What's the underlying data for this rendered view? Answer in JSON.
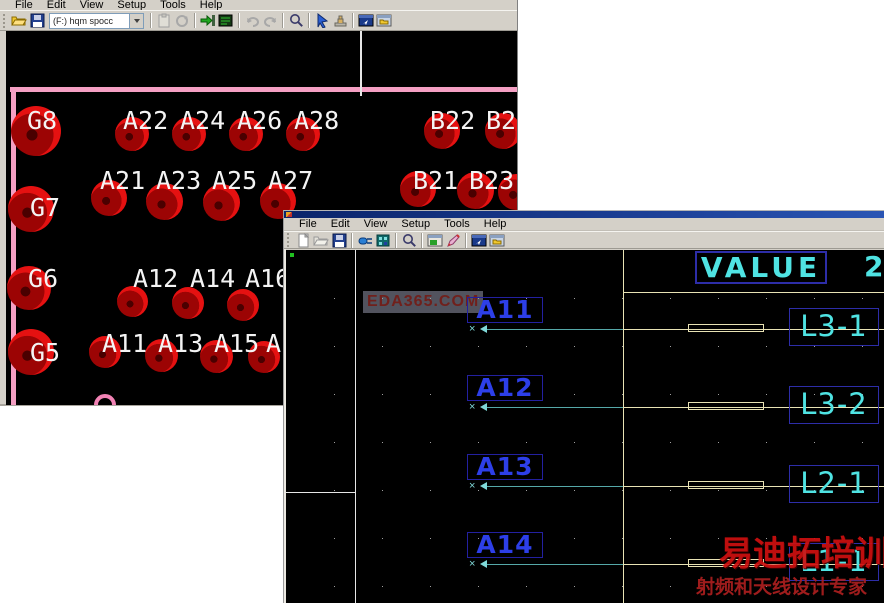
{
  "back_window": {
    "menu": [
      "File",
      "Edit",
      "View",
      "Setup",
      "Tools",
      "Help"
    ],
    "toolbar": {
      "layer_combo_value": "(F:) hqm spocc",
      "icons_file": [
        "open-folder",
        "save"
      ],
      "icons_main": [
        "sep",
        "paste",
        "refresh",
        "sep",
        "import-arrow",
        "board",
        "sep",
        "undo",
        "redo",
        "sep",
        "zoom",
        "sep",
        "select-cursor",
        "stamp",
        "sep",
        "window-arrow",
        "window-folder"
      ]
    },
    "canvas": {
      "board_outline_color": "#f49fc3",
      "pad_labels": [
        {
          "t": "G8",
          "x": 21,
          "y": 77
        },
        {
          "t": "G7",
          "x": 24,
          "y": 164
        },
        {
          "t": "G6",
          "x": 22,
          "y": 235
        },
        {
          "t": "G5",
          "x": 24,
          "y": 309
        },
        {
          "t": "A22",
          "x": 117,
          "y": 77
        },
        {
          "t": "A24",
          "x": 174,
          "y": 77
        },
        {
          "t": "A26",
          "x": 231,
          "y": 77
        },
        {
          "t": "A28",
          "x": 288,
          "y": 77
        },
        {
          "t": "B22",
          "x": 424,
          "y": 77
        },
        {
          "t": "B24",
          "x": 480,
          "y": 77
        },
        {
          "t": "A21",
          "x": 94,
          "y": 137
        },
        {
          "t": "A23",
          "x": 150,
          "y": 137
        },
        {
          "t": "A25",
          "x": 206,
          "y": 137
        },
        {
          "t": "A27",
          "x": 262,
          "y": 137
        },
        {
          "t": "B21",
          "x": 407,
          "y": 137
        },
        {
          "t": "B23",
          "x": 463,
          "y": 137
        },
        {
          "t": "A12",
          "x": 127,
          "y": 235
        },
        {
          "t": "A14",
          "x": 184,
          "y": 235
        },
        {
          "t": "A16",
          "x": 239,
          "y": 235
        },
        {
          "t": "A11",
          "x": 96,
          "y": 300
        },
        {
          "t": "A13",
          "x": 152,
          "y": 300
        },
        {
          "t": "A15",
          "x": 208,
          "y": 300
        },
        {
          "t": "A17",
          "x": 260,
          "y": 300
        }
      ],
      "pads": [
        {
          "x": 30,
          "y": 100,
          "d": 50
        },
        {
          "x": 25,
          "y": 178,
          "d": 46
        },
        {
          "x": 23,
          "y": 257,
          "d": 44
        },
        {
          "x": 25,
          "y": 321,
          "d": 46
        },
        {
          "x": 126,
          "y": 103,
          "d": 34
        },
        {
          "x": 183,
          "y": 103,
          "d": 34
        },
        {
          "x": 240,
          "y": 103,
          "d": 34
        },
        {
          "x": 297,
          "y": 103,
          "d": 34
        },
        {
          "x": 436,
          "y": 100,
          "d": 36
        },
        {
          "x": 497,
          "y": 100,
          "d": 36
        },
        {
          "x": 103,
          "y": 167,
          "d": 36
        },
        {
          "x": 158,
          "y": 170,
          "d": 37
        },
        {
          "x": 215,
          "y": 171,
          "d": 37
        },
        {
          "x": 272,
          "y": 170,
          "d": 36
        },
        {
          "x": 412,
          "y": 158,
          "d": 36
        },
        {
          "x": 469,
          "y": 159,
          "d": 37
        },
        {
          "x": 510,
          "y": 161,
          "d": 36
        },
        {
          "x": 126,
          "y": 270,
          "d": 31
        },
        {
          "x": 182,
          "y": 272,
          "d": 32
        },
        {
          "x": 237,
          "y": 274,
          "d": 32
        },
        {
          "x": 99,
          "y": 321,
          "d": 32
        },
        {
          "x": 155,
          "y": 324,
          "d": 33
        },
        {
          "x": 210,
          "y": 325,
          "d": 33
        },
        {
          "x": 258,
          "y": 326,
          "d": 32
        }
      ]
    }
  },
  "front_window": {
    "menu": [
      "File",
      "Edit",
      "View",
      "Setup",
      "Tools",
      "Help"
    ],
    "toolbar": {
      "icons": [
        "new",
        "open-folder-gray",
        "save",
        "sep",
        "connector",
        "footprint",
        "sep",
        "zoom",
        "sep",
        "window-green",
        "pen",
        "sep",
        "window-arrow",
        "window-folder"
      ]
    },
    "canvas": {
      "value_label": "VALUE",
      "value_number": "2",
      "watermark": "EDA365.COM",
      "brand_line1": "易迪拓培训",
      "brand_line2": "射频和天线设计专家",
      "rows": [
        {
          "pin": "A11",
          "net": "L3-1",
          "y": 79
        },
        {
          "pin": "A12",
          "net": "L3-2",
          "y": 157
        },
        {
          "pin": "A13",
          "net": "L2-1",
          "y": 236
        },
        {
          "pin": "A14",
          "net": "L1-1",
          "y": 314
        }
      ]
    }
  }
}
